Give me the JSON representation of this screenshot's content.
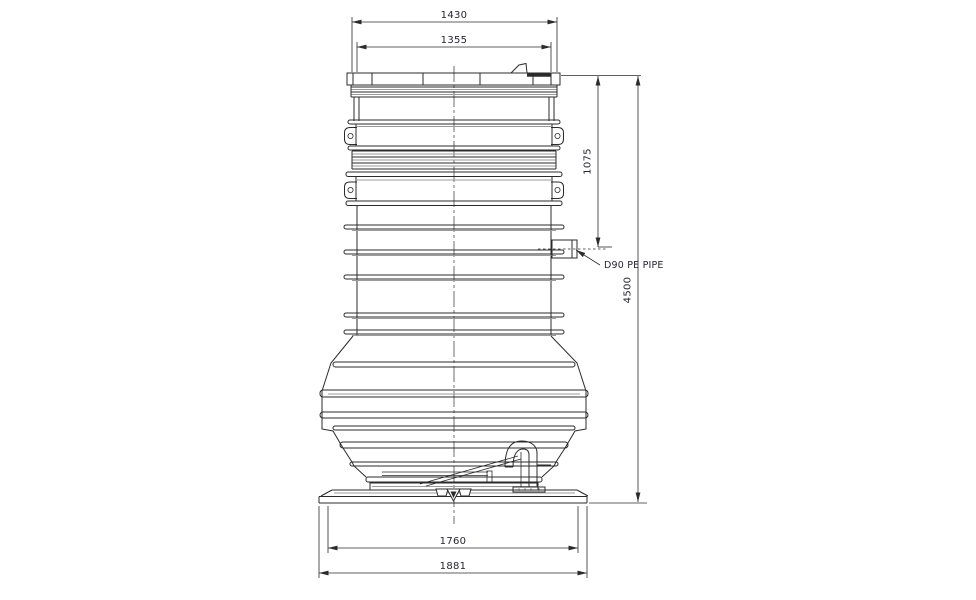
{
  "drawing": {
    "annotations": {
      "dim_top_outer": "1430",
      "dim_top_inner": "1355",
      "dim_inlet_height": "1075",
      "dim_overall_height": "4500",
      "note_inlet_pipe": "D90 PE PIPE",
      "dim_base_inner": "1760",
      "dim_base_outer": "1881"
    },
    "colors": {
      "background": "#ffffff",
      "object_line": "#2b2b2b",
      "accent_line": "#9b9b9b",
      "dimension_text": "#26262e"
    }
  }
}
